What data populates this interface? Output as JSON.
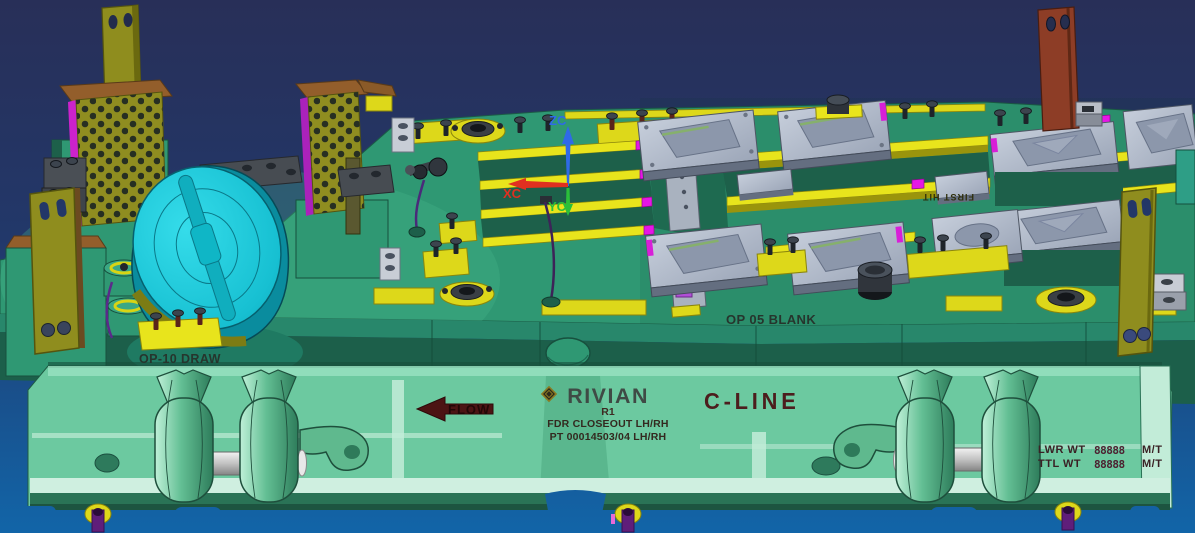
{
  "labels": {
    "op10_draw": "OP-10 DRAW",
    "op05_blank": "OP 05 BLANK",
    "first_hit": "FIRST HIT",
    "flow": "FLOW"
  },
  "nameplate": {
    "brand": "RIVIAN",
    "revision": "R1",
    "line1": "FDR CLOSEOUT LH/RH",
    "line2": "PT 00014503/04 LH/RH",
    "program": "C-LINE"
  },
  "weights": {
    "rows": [
      {
        "label": "LWR WT",
        "value": "88888",
        "unit": "M/T"
      },
      {
        "label": "TTL WT",
        "value": "88888",
        "unit": "M/T"
      }
    ]
  },
  "triad": {
    "z": "ZC",
    "x": "XC",
    "y": "YC",
    "z_color": "#2f6ae8",
    "x_color": "#e03020",
    "y_color": "#2abf3a"
  },
  "palette": {
    "background_top": "#282f58",
    "background_bottom": "#1265a8",
    "upper_die_green": "#2f9873",
    "lower_die_mint": "#6cc9a0",
    "rail_yellow": "#e8e41c",
    "accent_magenta": "#e616e6",
    "punch_cyan": "#17c6d6",
    "heel_olive": "#8f8d20",
    "post_red": "#8d3d26",
    "pad_gray": "#b6bfce",
    "marking_maroon": "#4c1d1d",
    "marking_dark": "#26352d"
  }
}
